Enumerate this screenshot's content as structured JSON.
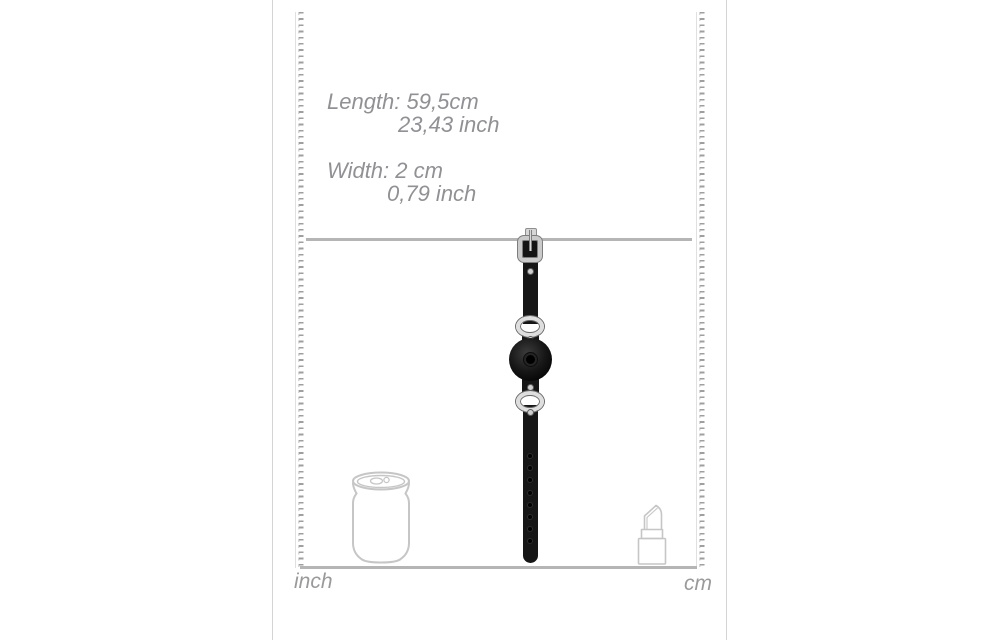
{
  "dimensions": {
    "length_cm": "Length: 59,5cm",
    "length_inch": "23,43 inch",
    "width_cm": "Width: 2 cm",
    "width_inch": "0,79 inch"
  },
  "rulers": {
    "left_unit": "inch",
    "right_unit": "cm"
  },
  "reference_objects": {
    "left": "soda-can-outline",
    "right": "lipstick-outline"
  },
  "colors": {
    "background": "#ffffff",
    "text_gray": "#919195",
    "line_gray": "#b5b5b5",
    "outline_gray": "#c6c6c6",
    "strap_black": "#161616",
    "metal_silver": "#cacaca"
  }
}
